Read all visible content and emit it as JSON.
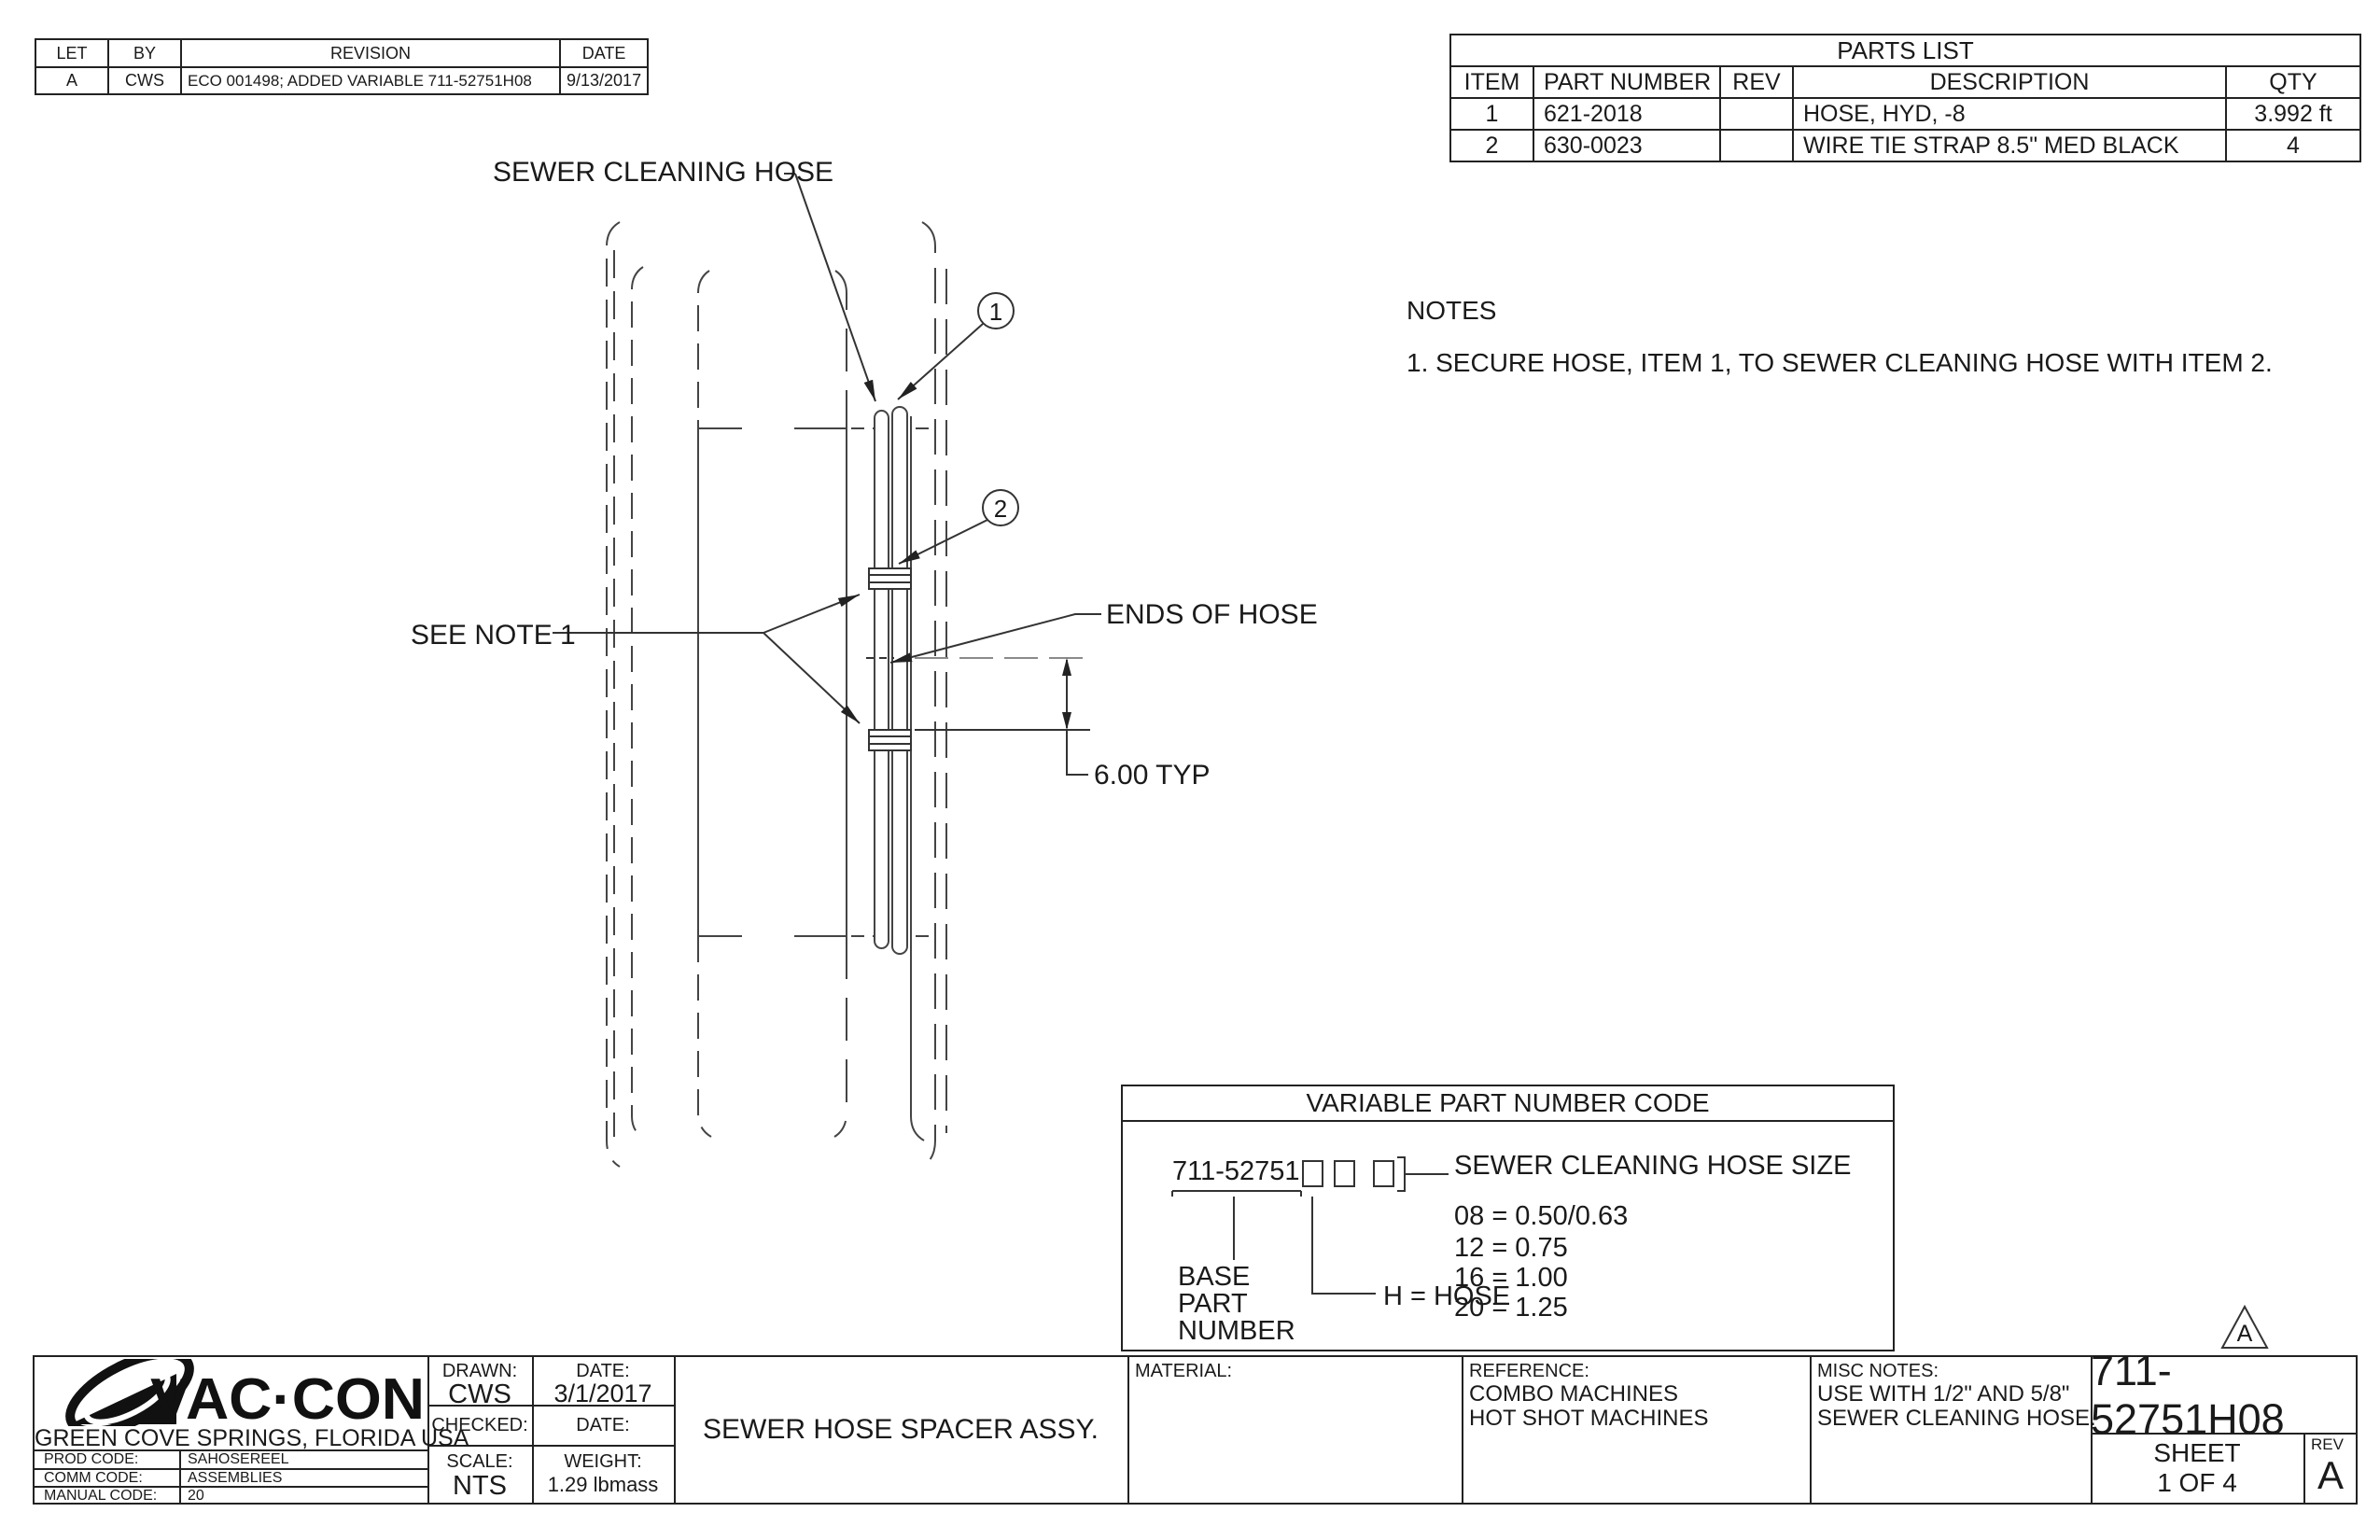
{
  "colors": {
    "ink": "#222222",
    "paper": "#ffffff",
    "centerline_gray": "#8a8a8a"
  },
  "revision_table": {
    "headers": {
      "let": "LET",
      "by": "BY",
      "revision": "REVISION",
      "date": "DATE"
    },
    "rows": [
      {
        "let": "A",
        "by": "CWS",
        "revision": "ECO 001498;  ADDED VARIABLE 711-52751H08",
        "date": "9/13/2017"
      }
    ]
  },
  "parts_list": {
    "title": "PARTS LIST",
    "headers": {
      "item": "ITEM",
      "part_number": "PART NUMBER",
      "rev": "REV",
      "description": "DESCRIPTION",
      "qty": "QTY"
    },
    "rows": [
      {
        "item": "1",
        "part_number": "621-2018",
        "rev": "",
        "description": "HOSE, HYD, -8",
        "qty": "3.992 ft"
      },
      {
        "item": "2",
        "part_number": "630-0023",
        "rev": "",
        "description": "WIRE TIE STRAP 8.5\" MED BLACK",
        "qty": "4"
      }
    ]
  },
  "notes": {
    "title": "NOTES",
    "item_1": "1.  SECURE HOSE, ITEM 1, TO SEWER CLEANING HOSE WITH ITEM 2."
  },
  "drawing": {
    "label_sewer_cleaning_hose": "SEWER CLEANING HOSE",
    "label_see_note_1": "SEE NOTE 1",
    "label_ends_of_hose": "ENDS OF HOSE",
    "dimension": "6.00 TYP",
    "balloon_1": "1",
    "balloon_2": "2",
    "revision_triangle": "A"
  },
  "variable_code": {
    "title": "VARIABLE PART NUMBER CODE",
    "base_number": "711-52751",
    "size_label": "SEWER CLEANING HOSE SIZE",
    "sizes": [
      "08 = 0.50/0.63",
      "12 = 0.75",
      "16 = 1.00",
      "20 = 1.25"
    ],
    "hose_code": "H = HOSE",
    "base_label": [
      "BASE",
      "PART",
      "NUMBER"
    ]
  },
  "title_block": {
    "logo_text": "VAC·CON",
    "location": "GREEN COVE SPRINGS, FLORIDA USA",
    "codes": [
      {
        "label": "PROD CODE:",
        "value": "SAHOSEREEL"
      },
      {
        "label": "COMM CODE:",
        "value": "ASSEMBLIES"
      },
      {
        "label": "MANUAL CODE:",
        "value": "20"
      }
    ],
    "drawn_label": "DRAWN:",
    "drawn": "CWS",
    "drawn_date_label": "DATE:",
    "drawn_date": "3/1/2017",
    "checked_label": "CHECKED:",
    "checked_date_label": "DATE:",
    "scale_label": "SCALE:",
    "scale": "NTS",
    "weight_label": "WEIGHT:",
    "weight": "1.29 lbmass",
    "drawing_title": "SEWER HOSE SPACER ASSY.",
    "material_label": "MATERIAL:",
    "reference_label": "REFERENCE:",
    "reference_lines": [
      "COMBO MACHINES",
      "HOT SHOT MACHINES"
    ],
    "misc_notes_label": "MISC NOTES:",
    "misc_notes_lines": [
      "USE WITH 1/2\" AND 5/8\"",
      "SEWER CLEANING HOSE."
    ],
    "part_number": "711-52751H08",
    "sheet_label": "SHEET",
    "sheet_value": "1 OF 4",
    "rev_label": "REV",
    "rev_value": "A"
  }
}
